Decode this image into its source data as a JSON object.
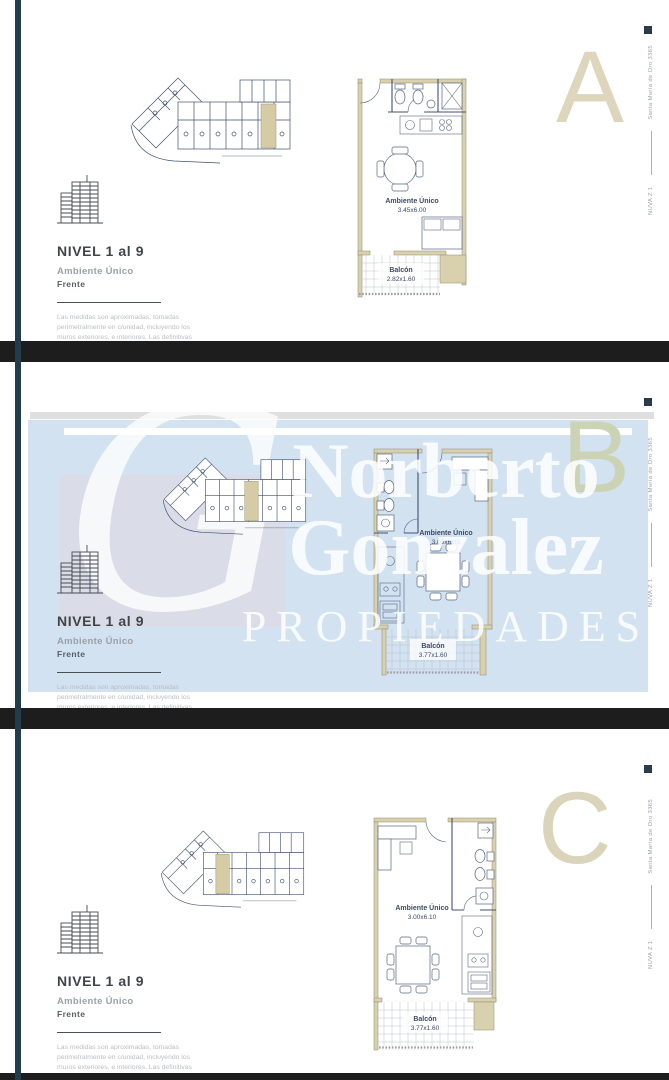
{
  "brand": {
    "monogram": "G",
    "name_line1": "Norberto",
    "name_line2": "Gonzalez",
    "name_line3": "PROPIEDADES"
  },
  "side_label": {
    "project": "NUVA Z 1",
    "address": "Santa María de Oro 3365"
  },
  "panels": [
    {
      "letter": "A",
      "level_title": "NIVEL 1 al 9",
      "unit_type": "Ambiente Único",
      "orientation": "Frente",
      "disclaimer": "Las medidas son aproximadas, tomadas perimetralmente en c/unidad, incluyendo los muros exteriores, e interiores. Las definitivas surgirán de la obra y del plano de mensura.",
      "room_label": "Ambiente Único",
      "room_dims": "3.45x6.00",
      "balcony_label": "Balcón",
      "balcony_dims": "2.82x1.60"
    },
    {
      "letter": "B",
      "level_title": "NIVEL 1 al 9",
      "unit_type": "Ambiente Único",
      "orientation": "Frente",
      "disclaimer": "Las medidas son aproximadas, tomadas perimetralmente en c/unidad, incluyendo los muros exteriores, e interiores. Las definitivas surgirán de la obra y del plano de mensura.",
      "room_label": "Ambiente Único",
      "room_dims": "3.00x6.35",
      "balcony_label": "Balcón",
      "balcony_dims": "3.77x1.60"
    },
    {
      "letter": "C",
      "level_title": "NIVEL 1 al 9",
      "unit_type": "Ambiente Único",
      "orientation": "Frente",
      "disclaimer": "Las medidas son aproximadas, tomadas perimetralmente en c/unidad, incluyendo los muros exteriores, e interiores. Las definitivas surgirán de la obra y del plano de mensura.",
      "room_label": "Ambiente Único",
      "room_dims": "3.00x6.10",
      "balcony_label": "Balcón",
      "balcony_dims": "3.77x1.60"
    }
  ],
  "colors": {
    "accent_bar": "#223c4e",
    "divider_bar": "#1d1d1d",
    "plan_line": "#44516e",
    "wall_fill": "#d9d1ae",
    "highlight_unit": "#d5cca6",
    "unit_letter_a": "#ddd6bd",
    "unit_letter_b": "#ccd2b4",
    "unit_letter_c": "#dad4ba",
    "watermark_band": "#d2e2f1",
    "watermark_text": "#ffffff",
    "monogram_square": "#dcdbe5"
  }
}
